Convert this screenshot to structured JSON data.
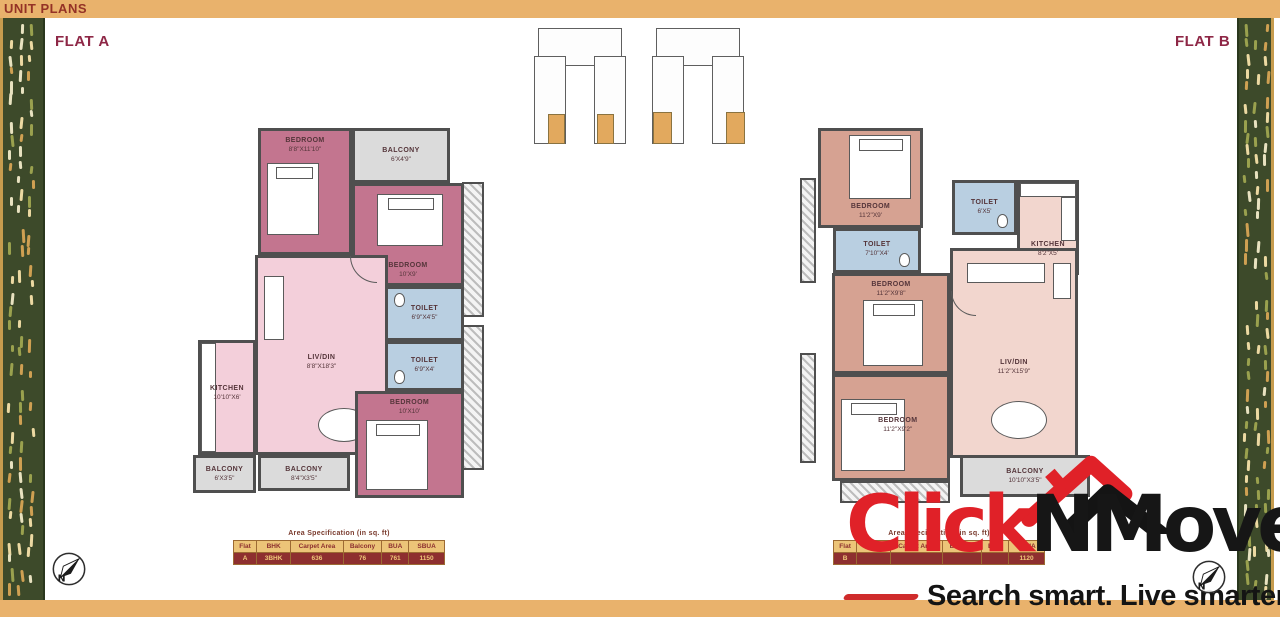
{
  "header": {
    "title": "UNIT PLANS"
  },
  "flat_a": {
    "label": "FLAT A",
    "rooms": [
      {
        "name": "BEDROOM",
        "size": "8'8\"X11'10\""
      },
      {
        "name": "BALCONY",
        "size": "6'X4'9\""
      },
      {
        "name": "BEDROOM",
        "size": "10'X9'"
      },
      {
        "name": "TOILET",
        "size": "6'9\"X4'5\""
      },
      {
        "name": "TOILET",
        "size": "6'9\"X4'"
      },
      {
        "name": "LIV/DIN",
        "size": "8'8\"X18'3\""
      },
      {
        "name": "KITCHEN",
        "size": "10'10\"X6'"
      },
      {
        "name": "BEDROOM",
        "size": "10'X10'"
      },
      {
        "name": "BALCONY",
        "size": "6'X3'5\""
      },
      {
        "name": "BALCONY",
        "size": "8'4\"X3'5\""
      }
    ],
    "table": {
      "title": "Area Specification (in sq. ft)",
      "headers": [
        "Flat",
        "BHK",
        "Carpet Area",
        "Balcony",
        "BUA",
        "SBUA"
      ],
      "row": [
        "A",
        "3BHK",
        "636",
        "76",
        "761",
        "1150"
      ]
    }
  },
  "flat_b": {
    "label": "FLAT B",
    "rooms": [
      {
        "name": "BEDROOM",
        "size": "11'2\"X9'"
      },
      {
        "name": "TOILET",
        "size": "6'X5'"
      },
      {
        "name": "KITCHEN",
        "size": "8'2\"X5'"
      },
      {
        "name": "TOILET",
        "size": "7'10\"X4'"
      },
      {
        "name": "BEDROOM",
        "size": "11'2\"X9'8\""
      },
      {
        "name": "LIV/DIN",
        "size": "11'2\"X15'9\""
      },
      {
        "name": "BEDROOM",
        "size": "11'2\"X9'2\""
      },
      {
        "name": "BALCONY",
        "size": "10'10\"X3'5\""
      }
    ],
    "table": {
      "title": "Area Specification (in sq. ft)",
      "headers": [
        "Flat",
        "BHK",
        "Carpet Area",
        "Balcony",
        "BUA",
        "SBUA"
      ],
      "row": [
        "B",
        "",
        "",
        "",
        "",
        "1120"
      ]
    }
  },
  "logo": {
    "brand_red": "Click",
    "brand_black": "NMove",
    "tagline": "Search smart. Live smarter."
  },
  "compass": {
    "label": "N"
  },
  "colors": {
    "accent_tan": "#e9b26c",
    "maroon": "#8e2746",
    "brand_red": "#e02128",
    "strip_green": "#3d4a2a",
    "table_header_bg": "#ecc478",
    "table_row_bg": "#8e2f2f"
  }
}
